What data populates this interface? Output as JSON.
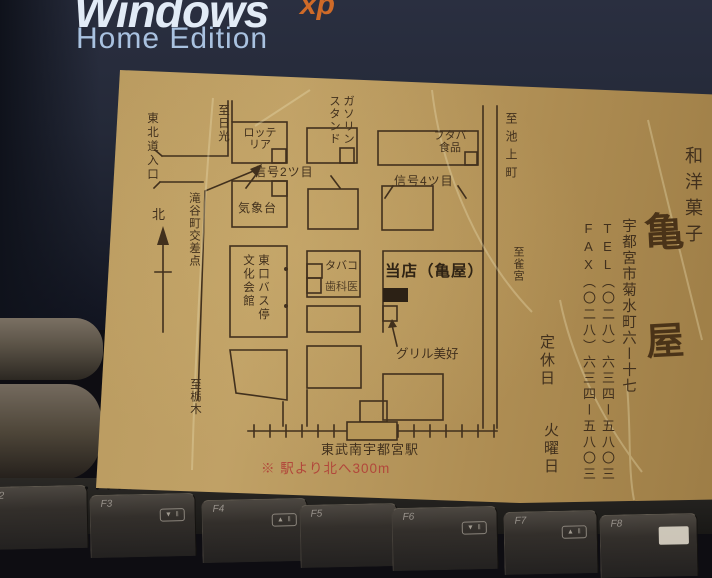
{
  "background": {
    "windows_word": "Windows",
    "xp": "xp",
    "home_edition": "Home Edition"
  },
  "card": {
    "map": {
      "tohoku_entrance": "東北道入口",
      "to_nikko": "至日光",
      "lotteria": "ロッテ\nリア",
      "gas_station": "ガソリン\nスタンド",
      "futaba": "フタバ\n食品",
      "to_ikegamicho": "至池上町",
      "signal_2": "信号2ツ目",
      "signal_4": "信号4ツ目",
      "weather_station": "気象台",
      "takiyacho_crossing": "滝谷町交差点",
      "north": "北",
      "bus_stop_and_hall": "東口バス停\n文化会館",
      "tabako": "タバコ",
      "dental": "歯科医",
      "our_shop": "当店（亀屋）",
      "grill_miyoshi": "グリル美好",
      "to_suzumenomiya": "至雀宮",
      "to_tochigi": "至栃木",
      "station_name": "東武南宇都宮駅",
      "note_red": "※ 駅より北へ300m"
    },
    "info": {
      "shop_type": "和洋菓子",
      "shop_name_char1": "亀",
      "shop_name_char2": "屋",
      "address": "宇都宮市菊水町六ー十七",
      "tel": "TEL（〇二八）六三四ー五八〇三",
      "fax": "FAX（〇二八）六三四ー五八〇三",
      "closed_label": "定休日",
      "closed_day": "火曜日"
    }
  },
  "keyboard": {
    "keys": [
      {
        "label": "F2",
        "icon": ""
      },
      {
        "label": "F3",
        "icon": "▼ ‖"
      },
      {
        "label": "F4",
        "icon": "▲ ‖"
      },
      {
        "label": "F5",
        "icon": ""
      },
      {
        "label": "F6",
        "icon": "▼ ‖"
      },
      {
        "label": "F7",
        "icon": "▲ ‖"
      },
      {
        "label": "F8",
        "icon": ""
      }
    ]
  },
  "colors": {
    "card_tan": "#b6975c",
    "map_ink": "#41301d",
    "note_red": "#b2473b",
    "screen_navy": "#242938",
    "xp_orange": "#cf6a28",
    "windows_text": "#e2ebf6",
    "home_edition_text": "#a9c2e0"
  }
}
